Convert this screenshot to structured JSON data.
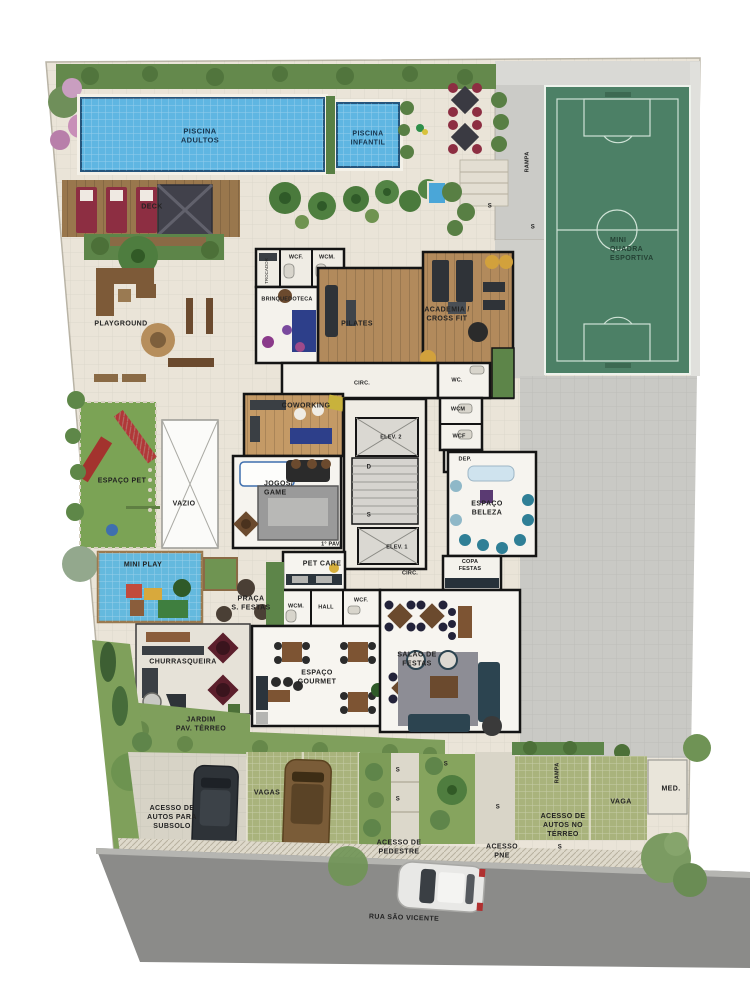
{
  "title": "Implantação - Pavimento Térreo",
  "labels": {
    "piscina_adultos": "PISCINA\nADULTOS",
    "piscina_infantil": "PISCINA\nINFANTIL",
    "deck": "DECK",
    "rampa": "RAMPA",
    "mini_quadra": "MINI\nQUADRA\nESPORTIVA",
    "playground": "PLAYGROUND",
    "trocador": "TROCADOR",
    "wcf_dot": "WCF.",
    "wcm_dot": "WCM.",
    "brinquedoteca": "BRINQUEDOTECA",
    "pilates": "PILATES",
    "academia": "ACADEMIA /\nCROSS FIT",
    "circ": "CIRC.",
    "wc": "WC.",
    "coworking": "COWORKING",
    "elev2": "ELEV. 2",
    "elev1": "ELEV. 1",
    "wcm": "WCM",
    "wcf": "WCF",
    "dep": "DEP.",
    "espaco_pet": "ESPAÇO PET",
    "vazio": "VAZIO",
    "jogos_game": "JOGOS/\nGAME",
    "espaco_beleza": "ESPAÇO\nBELEZA",
    "pav1": "1° PAV.",
    "copa_festas": "COPA\nFESTAS",
    "mini_play": "MINI PLAY",
    "pet_care": "PET CARE",
    "praca_festas": "PRAÇA\nS. FESTAS",
    "hall": "HALL",
    "churrasqueira": "CHURRASQUEIRA",
    "salao_festas": "SALÃO DE\nFESTAS",
    "espaco_gourmet": "ESPAÇO\nGOURMET",
    "jardim": "JARDIM\nPAV. TÉRREO",
    "vagas": "VAGAS",
    "acesso_subsolo": "ACESSO DE\nAUTOS PARA\nSUBSOLO",
    "acesso_pedestre": "ACESSO DE\nPEDESTRE",
    "acesso_pne": "ACESSO\nPNE",
    "acesso_terreo": "ACESSO DE\nAUTOS NO\nTÉRREO",
    "vaga": "VAGA",
    "med": "MED.",
    "rua": "RUA SÃO VICENTE"
  },
  "markers": {
    "s": "S",
    "d": "D"
  },
  "colors": {
    "pool_water": "#5fb6e2",
    "pool_edge": "#26557c",
    "court_green": "#4c8066",
    "court_lines": "#cfe2d6",
    "pavement_cream": "#eae4d8",
    "pavement_gray": "#cbcbc7",
    "street_asphalt": "#8b8b89",
    "grass": "#7ba355",
    "wood_deck": "#99774d",
    "wood_floor": "#b28a5c",
    "wall": "#141414",
    "lounger_red": "#8d2e42",
    "parking_green": "#a9b37c"
  }
}
